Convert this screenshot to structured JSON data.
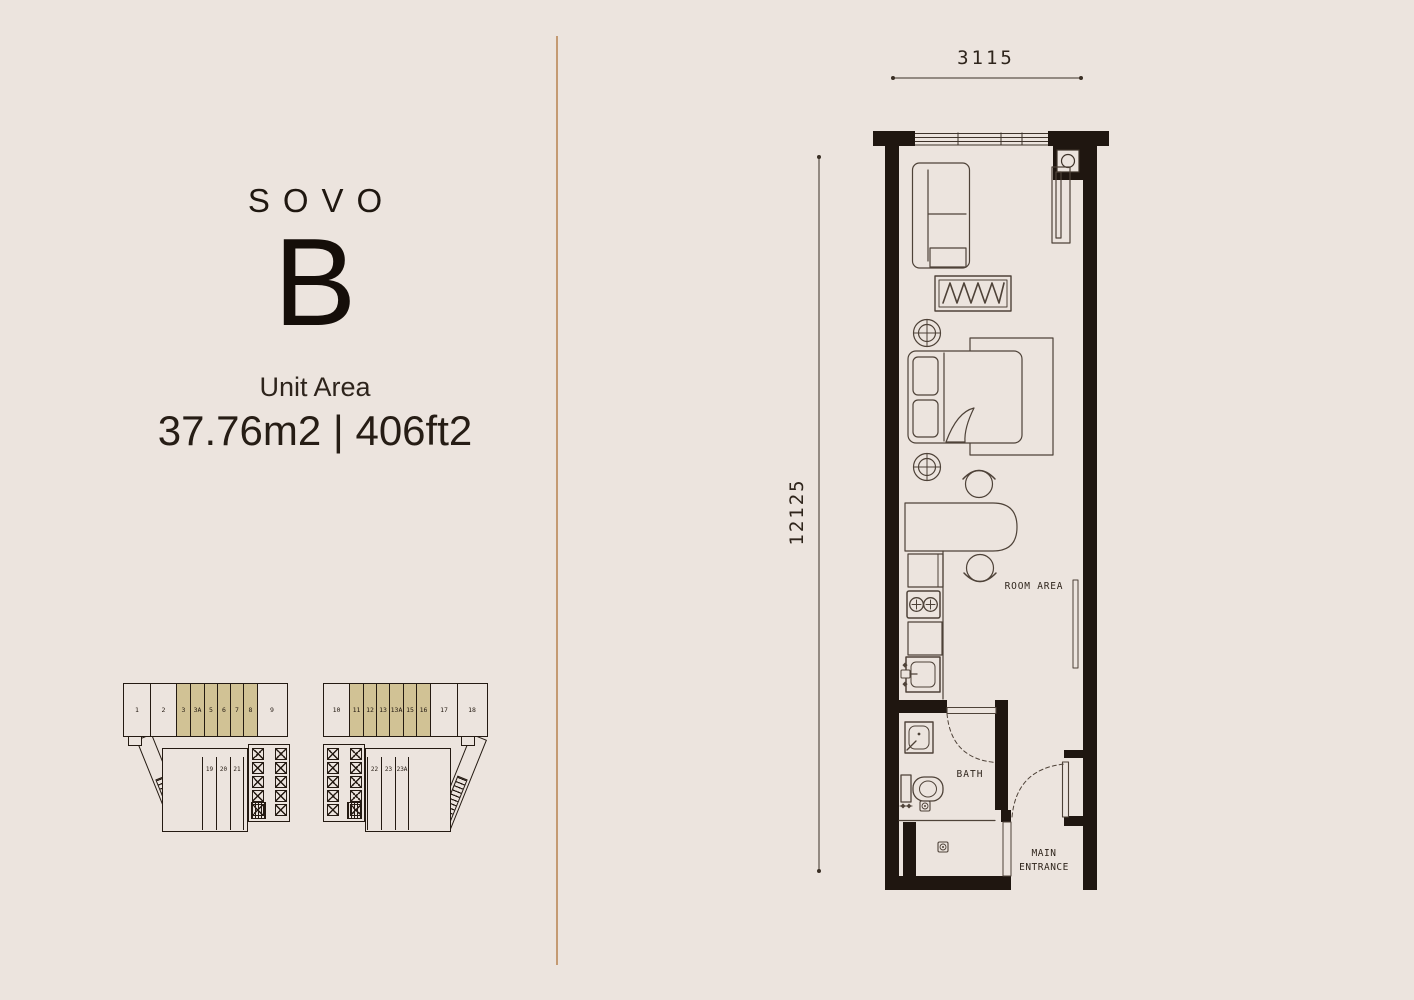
{
  "page": {
    "bg_color": "#ECE4DE",
    "ink_color": "#1F1610",
    "highlight_color": "#D1C295",
    "divider_color": "#C49A72"
  },
  "unit": {
    "brand": "SOVO",
    "type": "B",
    "area_label": "Unit Area",
    "area_value": "37.76m2 | 406ft2"
  },
  "plan": {
    "dim_width": "3115",
    "dim_height": "12125",
    "labels": {
      "room": "ROOM AREA",
      "bath": "BATH",
      "entrance1": "MAIN",
      "entrance2": "ENTRANCE"
    }
  },
  "keyplans": [
    {
      "name": "tower-left",
      "row_units": [
        {
          "label": "1",
          "w": 27,
          "hl": false
        },
        {
          "label": "2",
          "w": 26,
          "hl": false
        },
        {
          "label": "3",
          "w": 14,
          "hl": true
        },
        {
          "label": "3A",
          "w": 14,
          "hl": true
        },
        {
          "label": "5",
          "w": 13,
          "hl": true
        },
        {
          "label": "6",
          "w": 13,
          "hl": true
        },
        {
          "label": "7",
          "w": 13,
          "hl": true
        },
        {
          "label": "8",
          "w": 14,
          "hl": true
        },
        {
          "label": "9",
          "w": 28,
          "hl": false
        }
      ],
      "lower_units": [
        "19",
        "20",
        "21"
      ],
      "lift_count": 10
    },
    {
      "name": "tower-right",
      "row_units": [
        {
          "label": "10",
          "w": 26,
          "hl": false
        },
        {
          "label": "11",
          "w": 14,
          "hl": true
        },
        {
          "label": "12",
          "w": 13,
          "hl": true
        },
        {
          "label": "13",
          "w": 13,
          "hl": true
        },
        {
          "label": "13A",
          "w": 14,
          "hl": true
        },
        {
          "label": "15",
          "w": 13,
          "hl": true
        },
        {
          "label": "16",
          "w": 14,
          "hl": true
        },
        {
          "label": "17",
          "w": 27,
          "hl": false
        },
        {
          "label": "18",
          "w": 28,
          "hl": false
        }
      ],
      "lower_units": [
        "22",
        "23",
        "23A"
      ],
      "lift_count": 10
    }
  ]
}
